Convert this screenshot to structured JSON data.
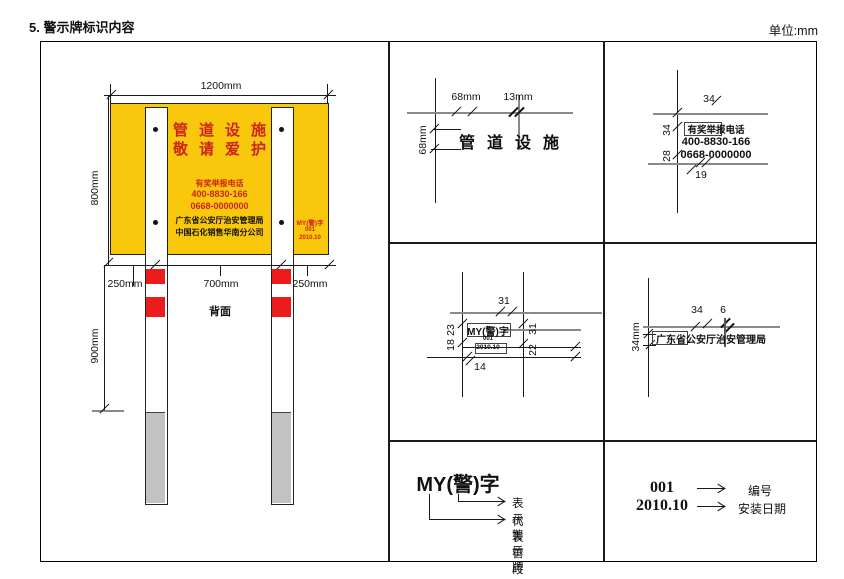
{
  "header": {
    "title": "5. 警示牌标识内容",
    "unit": "单位:mm"
  },
  "front": {
    "dim_width": "1200mm",
    "dim_height": "800mm",
    "dim_seg_left": "250mm",
    "dim_seg_mid": "700mm",
    "dim_seg_right": "250mm",
    "dim_post_depth": "900mm",
    "back_label": "背面",
    "board": {
      "title1": "管道设施",
      "title2": "敬请爱护",
      "hotline_caption": "有奖举报电话",
      "phone1": "400-8830-166",
      "phone2": "0668-0000000",
      "org1": "广东省公安厅治安管理局",
      "org2": "中国石化销售华南分公司",
      "code1": "MY(警)字",
      "code2": "001",
      "code3": "2010.10"
    }
  },
  "detail_title": {
    "text": "管道设施",
    "dim_char_width": "68mm",
    "dim_gap": "13mm",
    "dim_char_height": "68mm"
  },
  "detail_phone": {
    "line1": "有奖举报电话",
    "line2": "400-8830-166",
    "line3": "0668-0000000",
    "dim_top": "34",
    "dim_left_upper": "34",
    "dim_left_lower": "28",
    "dim_bottom": "19"
  },
  "detail_code": {
    "line1": "MY(警)字",
    "line2": "001",
    "line3": "2010.10",
    "dim_top": "31",
    "dim_left_upper": "23",
    "dim_left_lower": "18",
    "dim_right_upper": "31",
    "dim_right_lower": "22",
    "dim_bottom": "14"
  },
  "detail_org": {
    "text": "广东省公安厅治安管理局",
    "dim_char": "34",
    "dim_gap": "6",
    "dim_height": "34mm"
  },
  "legend_code": {
    "code": "MY(警)字",
    "arrow1_label": "表示警示牌",
    "arrow2_label": "代表管段"
  },
  "legend_num": {
    "number": "001",
    "number_label": "编号",
    "date": "2010.10",
    "date_label": "安装日期"
  },
  "colors": {
    "sign_yellow": "#F9C70B",
    "sign_red": "#CC2418",
    "band_red": "#EC1C1C",
    "post_gray": "#C2C2C2",
    "line_gray": "#8A8A8A"
  }
}
